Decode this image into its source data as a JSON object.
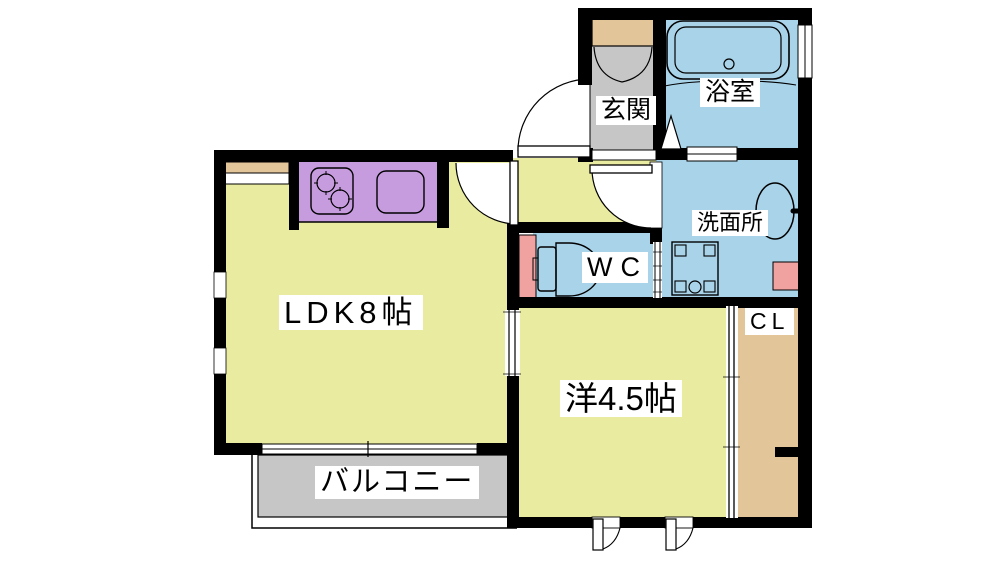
{
  "rooms": {
    "genkan": {
      "label": "玄関",
      "floor_color": "#c6c6c6"
    },
    "bathroom": {
      "label": "浴室",
      "floor_color": "#a9d3e9"
    },
    "washroom": {
      "label": "洗面所",
      "floor_color": "#a9d3e9"
    },
    "wc": {
      "label": "WC",
      "floor_color": "#a9d3e9"
    },
    "ldk": {
      "label": "LDK8帖",
      "floor_color": "#e9eca0"
    },
    "western_room": {
      "label": "洋4.5帖",
      "floor_color": "#e9eca0"
    },
    "closet": {
      "label": "CL",
      "floor_color": "#e3c59a"
    },
    "balcony": {
      "label": "バルコニー",
      "floor_color": "#c6c6c6"
    }
  },
  "colors": {
    "wall": "#000000",
    "kitchen_counter": "#c79cdf",
    "shoe_cabinet": "#e3c59a",
    "window_counter": "#e3c59a",
    "pipe_space": "#f0a2a0",
    "fixture_outline": "#000000",
    "background": "#ffffff"
  },
  "fixtures": {
    "icons": [
      "bathtub-icon",
      "toilet-icon",
      "washbasin-icon",
      "washing-machine-pan-icon",
      "stove-icon",
      "kitchen-sink-icon",
      "shoe-cabinet-icon",
      "door-swing-icon",
      "sliding-door-icon",
      "casement-window-icon",
      "folding-door-icon"
    ]
  }
}
